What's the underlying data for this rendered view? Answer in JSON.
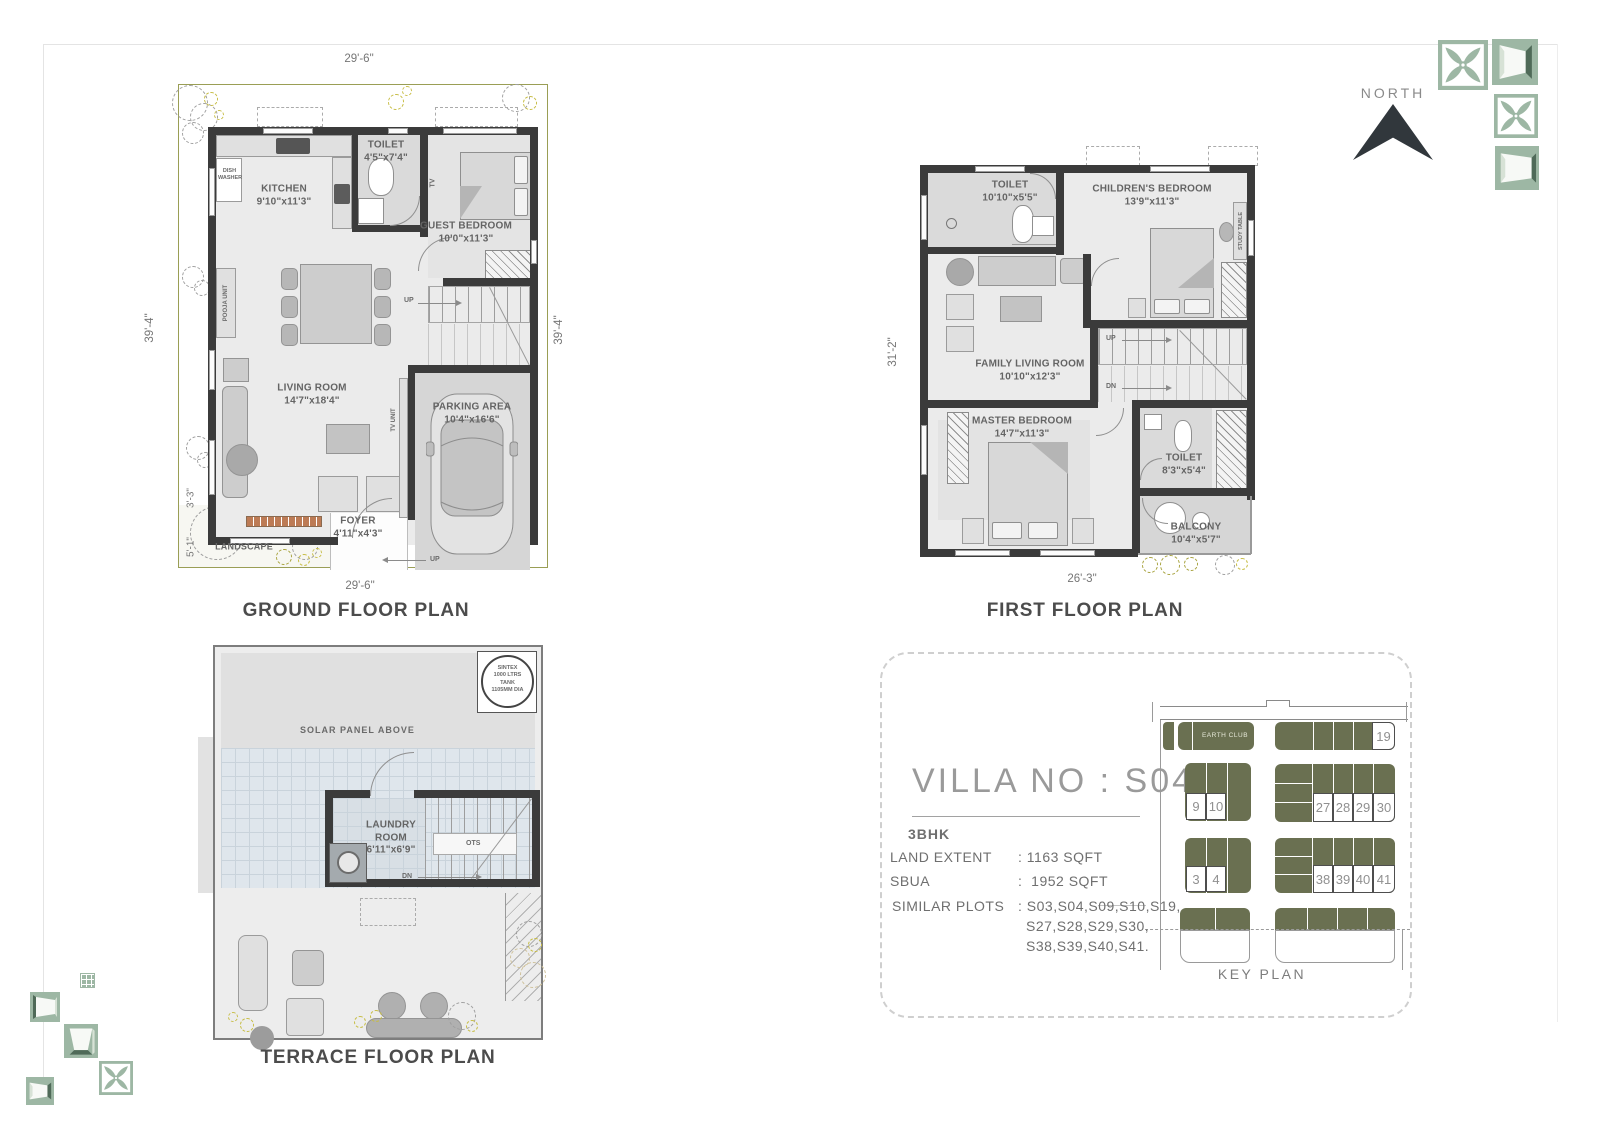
{
  "page": {
    "north_label": "NORTH"
  },
  "ground_floor": {
    "title": "GROUND FLOOR PLAN",
    "dims": {
      "top": "29'-6\"",
      "bottom": "29'-6\"",
      "left": "39'-4\"",
      "right": "39'-4\"",
      "small_a": "3'-3\"",
      "small_b": "5'-1\""
    },
    "rooms": {
      "kitchen": {
        "name": "KITCHEN",
        "size": "9'10\"x11'3\""
      },
      "toilet": {
        "name": "TOILET",
        "size": "4'5\"x7'4\""
      },
      "guest_bedroom": {
        "name": "GUEST BEDROOM",
        "size": "10'0\"x11'3\""
      },
      "living_room": {
        "name": "LIVING ROOM",
        "size": "14'7\"x18'4\""
      },
      "parking": {
        "name": "PARKING AREA",
        "size": "10'4\"x16'6\""
      },
      "foyer": {
        "name": "FOYER",
        "size": "4'11\"x4'3\""
      }
    },
    "labels": {
      "landscape": "LANDSCAPE",
      "dish_washer": "DISH WASHER",
      "pooja_unit": "POOJA UNIT",
      "tv": "TV",
      "tv_unit": "TV UNIT",
      "up": "UP"
    }
  },
  "first_floor": {
    "title": "FIRST FLOOR PLAN",
    "dims": {
      "left": "31'-2\"",
      "bottom": "26'-3\""
    },
    "rooms": {
      "toilet_top": {
        "name": "TOILET",
        "size": "10'10\"x5'5\""
      },
      "childrens_bedroom": {
        "name": "CHILDREN'S BEDROOM",
        "size": "13'9\"x11'3\""
      },
      "family_living": {
        "name": "FAMILY LIVING ROOM",
        "size": "10'10\"x12'3\""
      },
      "master_bedroom": {
        "name": "MASTER BEDROOM",
        "size": "14'7\"x11'3\""
      },
      "toilet_bottom": {
        "name": "TOILET",
        "size": "8'3\"x5'4\""
      },
      "balcony": {
        "name": "BALCONY",
        "size": "10'4\"x5'7\""
      }
    },
    "labels": {
      "study_table": "STUDY TABLE",
      "up": "UP",
      "dn": "DN"
    }
  },
  "terrace_floor": {
    "title": "TERRACE FLOOR PLAN",
    "solar_label": "SOLAR PANEL ABOVE",
    "tank": {
      "l1": "SINTEX",
      "l2": "1000 LTRS",
      "l3": "TANK",
      "l4": "1105MM DIA"
    },
    "laundry": {
      "name1": "LAUNDRY",
      "name2": "ROOM",
      "size": "6'11\"x6'9\""
    },
    "labels": {
      "ots": "OTS",
      "dn": "DN"
    }
  },
  "villa_info": {
    "title": "VILLA NO : S04",
    "type": "3BHK",
    "land_extent_label": "LAND EXTENT",
    "land_extent_value": ": 1163 SQFT",
    "sbua_label": "SBUA",
    "sbua_value": ":  1952 SQFT",
    "similar_label": "SIMILAR PLOTS",
    "similar_value1": ": S03,S04,S09,S10,S19,",
    "similar_value2": "S27,S28,S29,S30,",
    "similar_value3": "S38,S39,S40,S41."
  },
  "key_plan": {
    "label": "KEY PLAN",
    "earth_club": "EARTH CLUB",
    "n19": "19",
    "n9": "9",
    "n10": "10",
    "n27": "27",
    "n28": "28",
    "n29": "29",
    "n30": "30",
    "n3": "3",
    "n4": "4",
    "n38": "38",
    "n39": "39",
    "n40": "40",
    "n41": "41"
  },
  "colors": {
    "wall": "#3b3b3b",
    "plot_green": "#6a7051",
    "deco_green": "#9db7a4",
    "accent_line": "#8a8f45"
  }
}
